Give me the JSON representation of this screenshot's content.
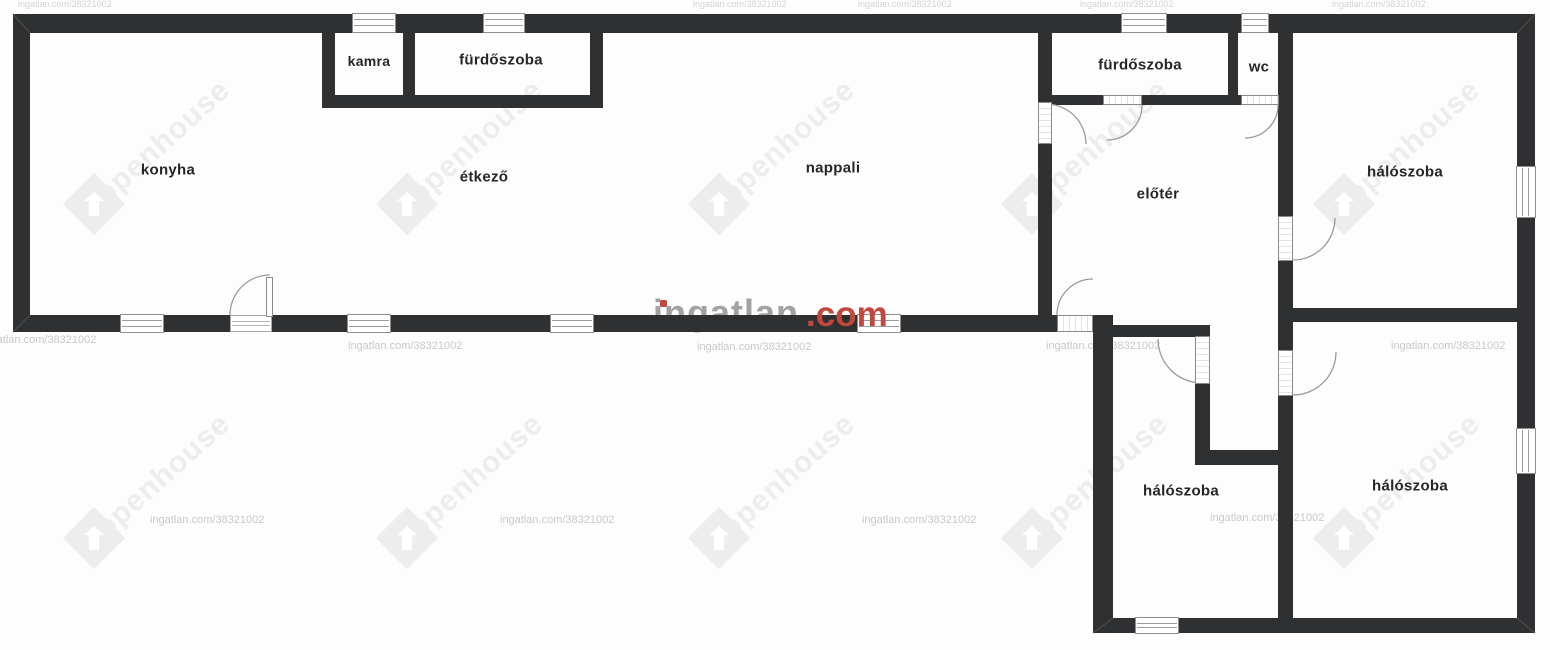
{
  "floorplan": {
    "rooms": [
      {
        "id": "konyha",
        "label": "konyha"
      },
      {
        "id": "kamra",
        "label": "kamra"
      },
      {
        "id": "furdoszoba-1",
        "label": "fürdőszoba"
      },
      {
        "id": "etkezo",
        "label": "étkező"
      },
      {
        "id": "nappali",
        "label": "nappali"
      },
      {
        "id": "furdoszoba-2",
        "label": "fürdőszoba"
      },
      {
        "id": "wc",
        "label": "wc"
      },
      {
        "id": "eloter",
        "label": "előtér"
      },
      {
        "id": "haloszoba-1",
        "label": "hálószoba"
      },
      {
        "id": "haloszoba-2",
        "label": "hálószoba"
      },
      {
        "id": "haloszoba-3",
        "label": "hálószoba"
      }
    ],
    "watermarks": {
      "brand": "openhouse",
      "listing_text": "ingatlan.com/38321002",
      "site_name": "ingatlan",
      "site_tld": ".com"
    },
    "colors": {
      "wall": "#2f3032",
      "accent_com": "#c2473c",
      "watermark_gray": "#ededed",
      "small_text_gray": "#c9c9c9"
    }
  }
}
